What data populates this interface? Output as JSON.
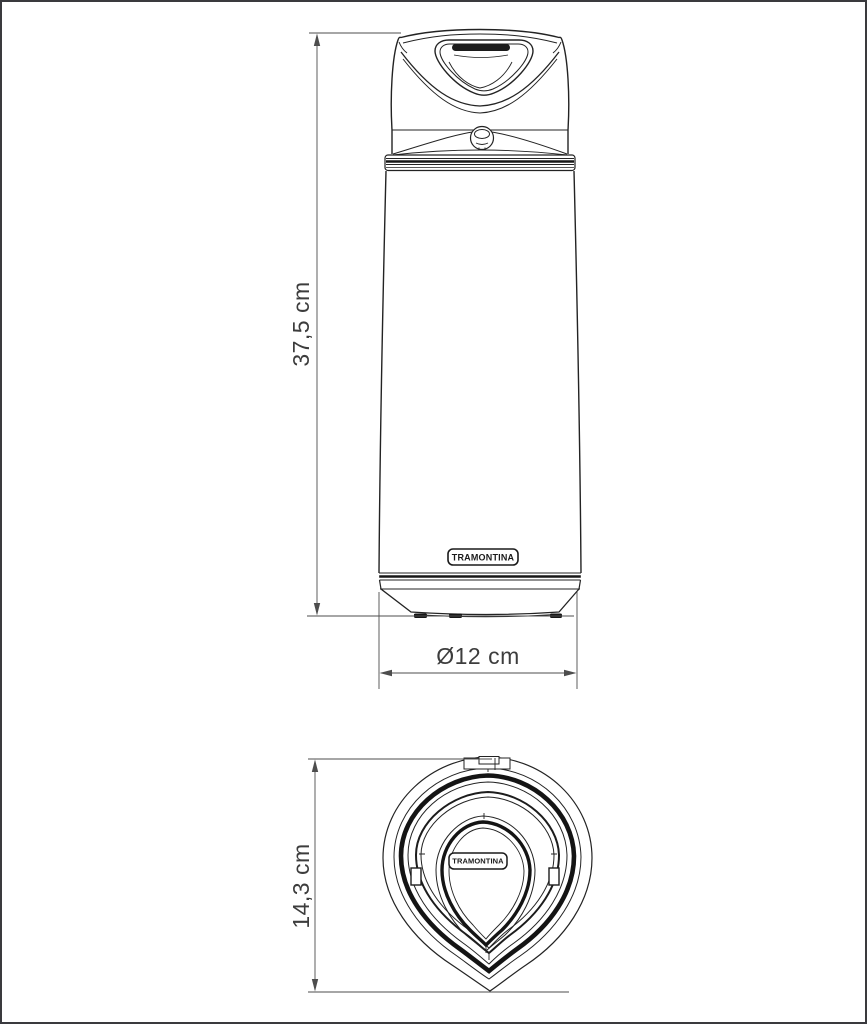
{
  "drawing": {
    "brand": "TRAMONTINA",
    "front_view": {
      "height_label": "37,5 cm",
      "diameter_label": "Ø12 cm"
    },
    "top_view": {
      "depth_label": "14,3 cm"
    }
  },
  "colors": {
    "line": "#232323",
    "dark_band": "#141414",
    "dimension_line": "#4d4d4d",
    "label_text": "#3d3d3d",
    "background": "#ffffff",
    "page_border": "#3a3a3e"
  }
}
